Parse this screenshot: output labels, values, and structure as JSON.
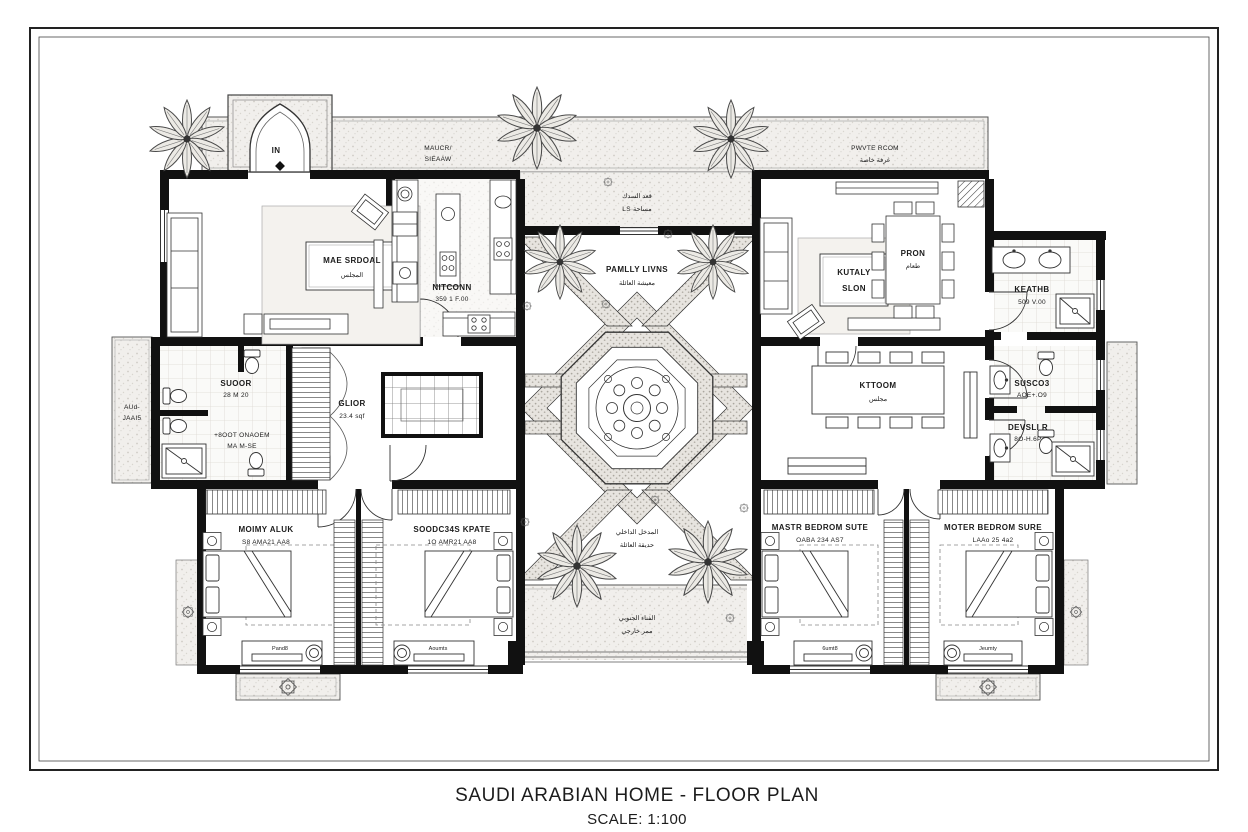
{
  "title": {
    "main": "SAUDI ARABIAN HOME - FLOOR PLAN",
    "scale": "SCALE: 1:100"
  },
  "labels": {
    "entrance": "IN",
    "terrace_top": {
      "l1": "MAUCR/",
      "l2": "SIEAAW"
    },
    "private_room": {
      "l1": "PWVTE RCOM",
      "l2": "غرفة خاصة"
    },
    "courtyard_top": {
      "l1": "قعد السدك",
      "l2": "LS مساحة"
    },
    "living": {
      "l1": "MAE SRDOAL",
      "l2": "المجلس"
    },
    "kitchen": {
      "l1": "NITCONN",
      "l2": "359 1 F.00"
    },
    "family": {
      "l1": "PAMLLY LIVNS",
      "l2": "معيشة العائلة"
    },
    "salon": {
      "l1": "KUTALY",
      "l2": "SLON"
    },
    "dining": {
      "l1": "PRON",
      "l2": "طعام"
    },
    "bath_keathb": {
      "l1": "KEATHB",
      "l2": "509 V.00"
    },
    "bath_suoor": {
      "l1": "SUOOR",
      "l2": "28 M 20"
    },
    "bath_onaoem": {
      "l1": "+8OOT ONAOEM",
      "l2": "MA M-SE"
    },
    "patio_left": {
      "l1": "AUd-",
      "l2": "JAAI5"
    },
    "hall": {
      "l1": "GLIOR",
      "l2": "23.4 sqf"
    },
    "majlis": {
      "l1": "KTTOOM",
      "l2": "مجلس"
    },
    "bath_susco": {
      "l1": "SUSCO3",
      "l2": "AOE+.O9"
    },
    "bath_devsli": {
      "l1": "DEVSLI R",
      "l2": "8O-H.6P"
    },
    "bedroom1": {
      "l1": "MOIMY ALUK",
      "l2": "S8 AMA21 AA8"
    },
    "bedroom2": {
      "l1": "SOODC34S KPATE",
      "l2": "1O AMR21 AA8"
    },
    "bedroom3": {
      "l1": "MASTR BEDROM SUTE",
      "l2": "OABA 234 AS7"
    },
    "bedroom4": {
      "l1": "MOTER BEDROM SURE",
      "l2": "LAAo 25 4a2"
    },
    "courtyard_bottom": {
      "l1": "المدخل الداخلي",
      "l2": "حديقة العائلة"
    },
    "terrace_bottom": {
      "l1": "الفناء الجنوبي",
      "l2": "ممر خارجي"
    },
    "dressers": {
      "d1": "Pand8",
      "d2": "Aoumts",
      "d3": "6umt8",
      "d4": "Jeumty"
    }
  },
  "colors": {
    "wall": "#111111",
    "line": "#333333",
    "paper": "#ffffff"
  }
}
